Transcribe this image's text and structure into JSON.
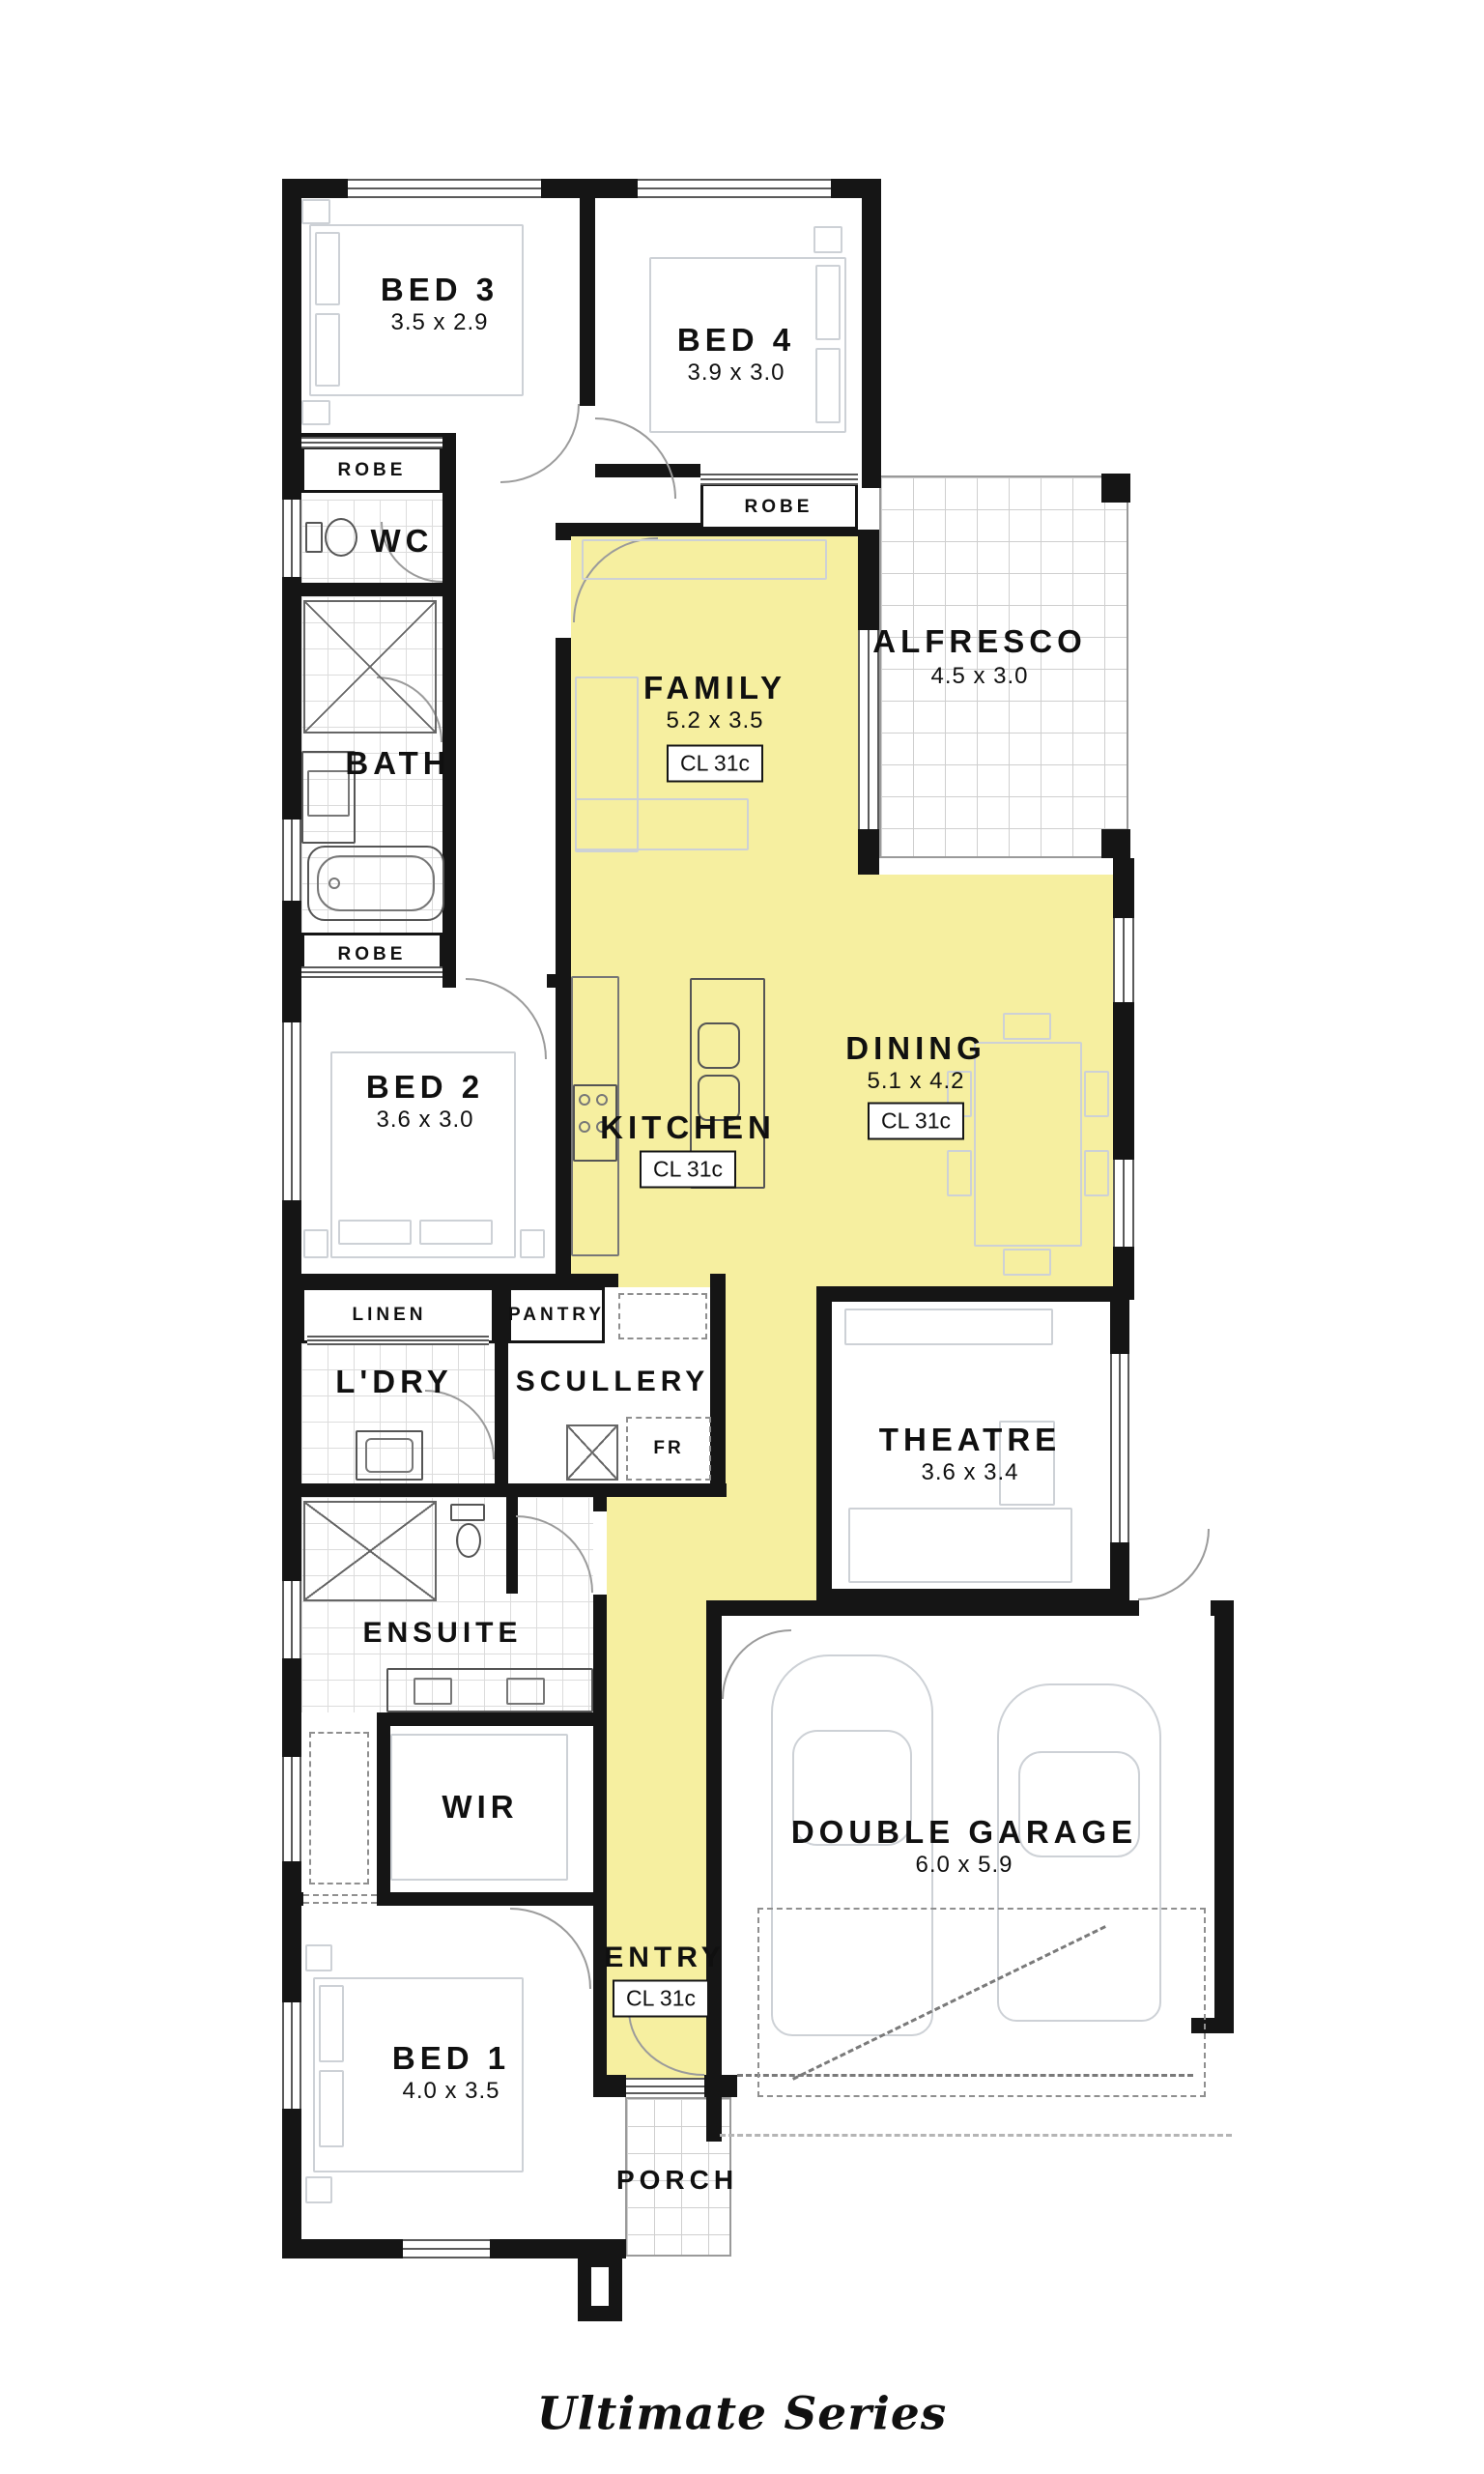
{
  "colors": {
    "highlight": "#F6EFA0",
    "wall": "#151515"
  },
  "rooms": {
    "bed3": {
      "name": "BED 3",
      "dims": "3.5 x 2.9"
    },
    "bed4": {
      "name": "BED 4",
      "dims": "3.9 x 3.0"
    },
    "family": {
      "name": "FAMILY",
      "dims": "5.2 x 3.5",
      "cl": "CL 31c"
    },
    "alfresco": {
      "name": "ALFRESCO",
      "dims": "4.5 x 3.0"
    },
    "wc": {
      "name": "WC"
    },
    "bath": {
      "name": "BATH"
    },
    "bed2": {
      "name": "BED 2",
      "dims": "3.6 x 3.0"
    },
    "kitchen": {
      "name": "KITCHEN",
      "cl": "CL 31c"
    },
    "dining": {
      "name": "DINING",
      "dims": "5.1 x 4.2",
      "cl": "CL 31c"
    },
    "laundry": {
      "name": "L'DRY"
    },
    "scullery": {
      "name": "SCULLERY"
    },
    "theatre": {
      "name": "THEATRE",
      "dims": "3.6 x 3.4"
    },
    "ensuite": {
      "name": "ENSUITE"
    },
    "wir": {
      "name": "WIR"
    },
    "garage": {
      "name": "DOUBLE GARAGE",
      "dims": "6.0 x 5.9"
    },
    "bed1": {
      "name": "BED 1",
      "dims": "4.0 x 3.5"
    },
    "entry": {
      "name": "ENTRY",
      "cl": "CL 31c"
    },
    "porch": {
      "name": "PORCH"
    }
  },
  "storage": {
    "robe_bed3": "ROBE",
    "robe_bed4": "ROBE",
    "robe_bed2": "ROBE",
    "linen": "LINEN",
    "pantry": "PANTRY",
    "fridge": "FR"
  },
  "branding": {
    "series_name": "Ultimate Series"
  }
}
